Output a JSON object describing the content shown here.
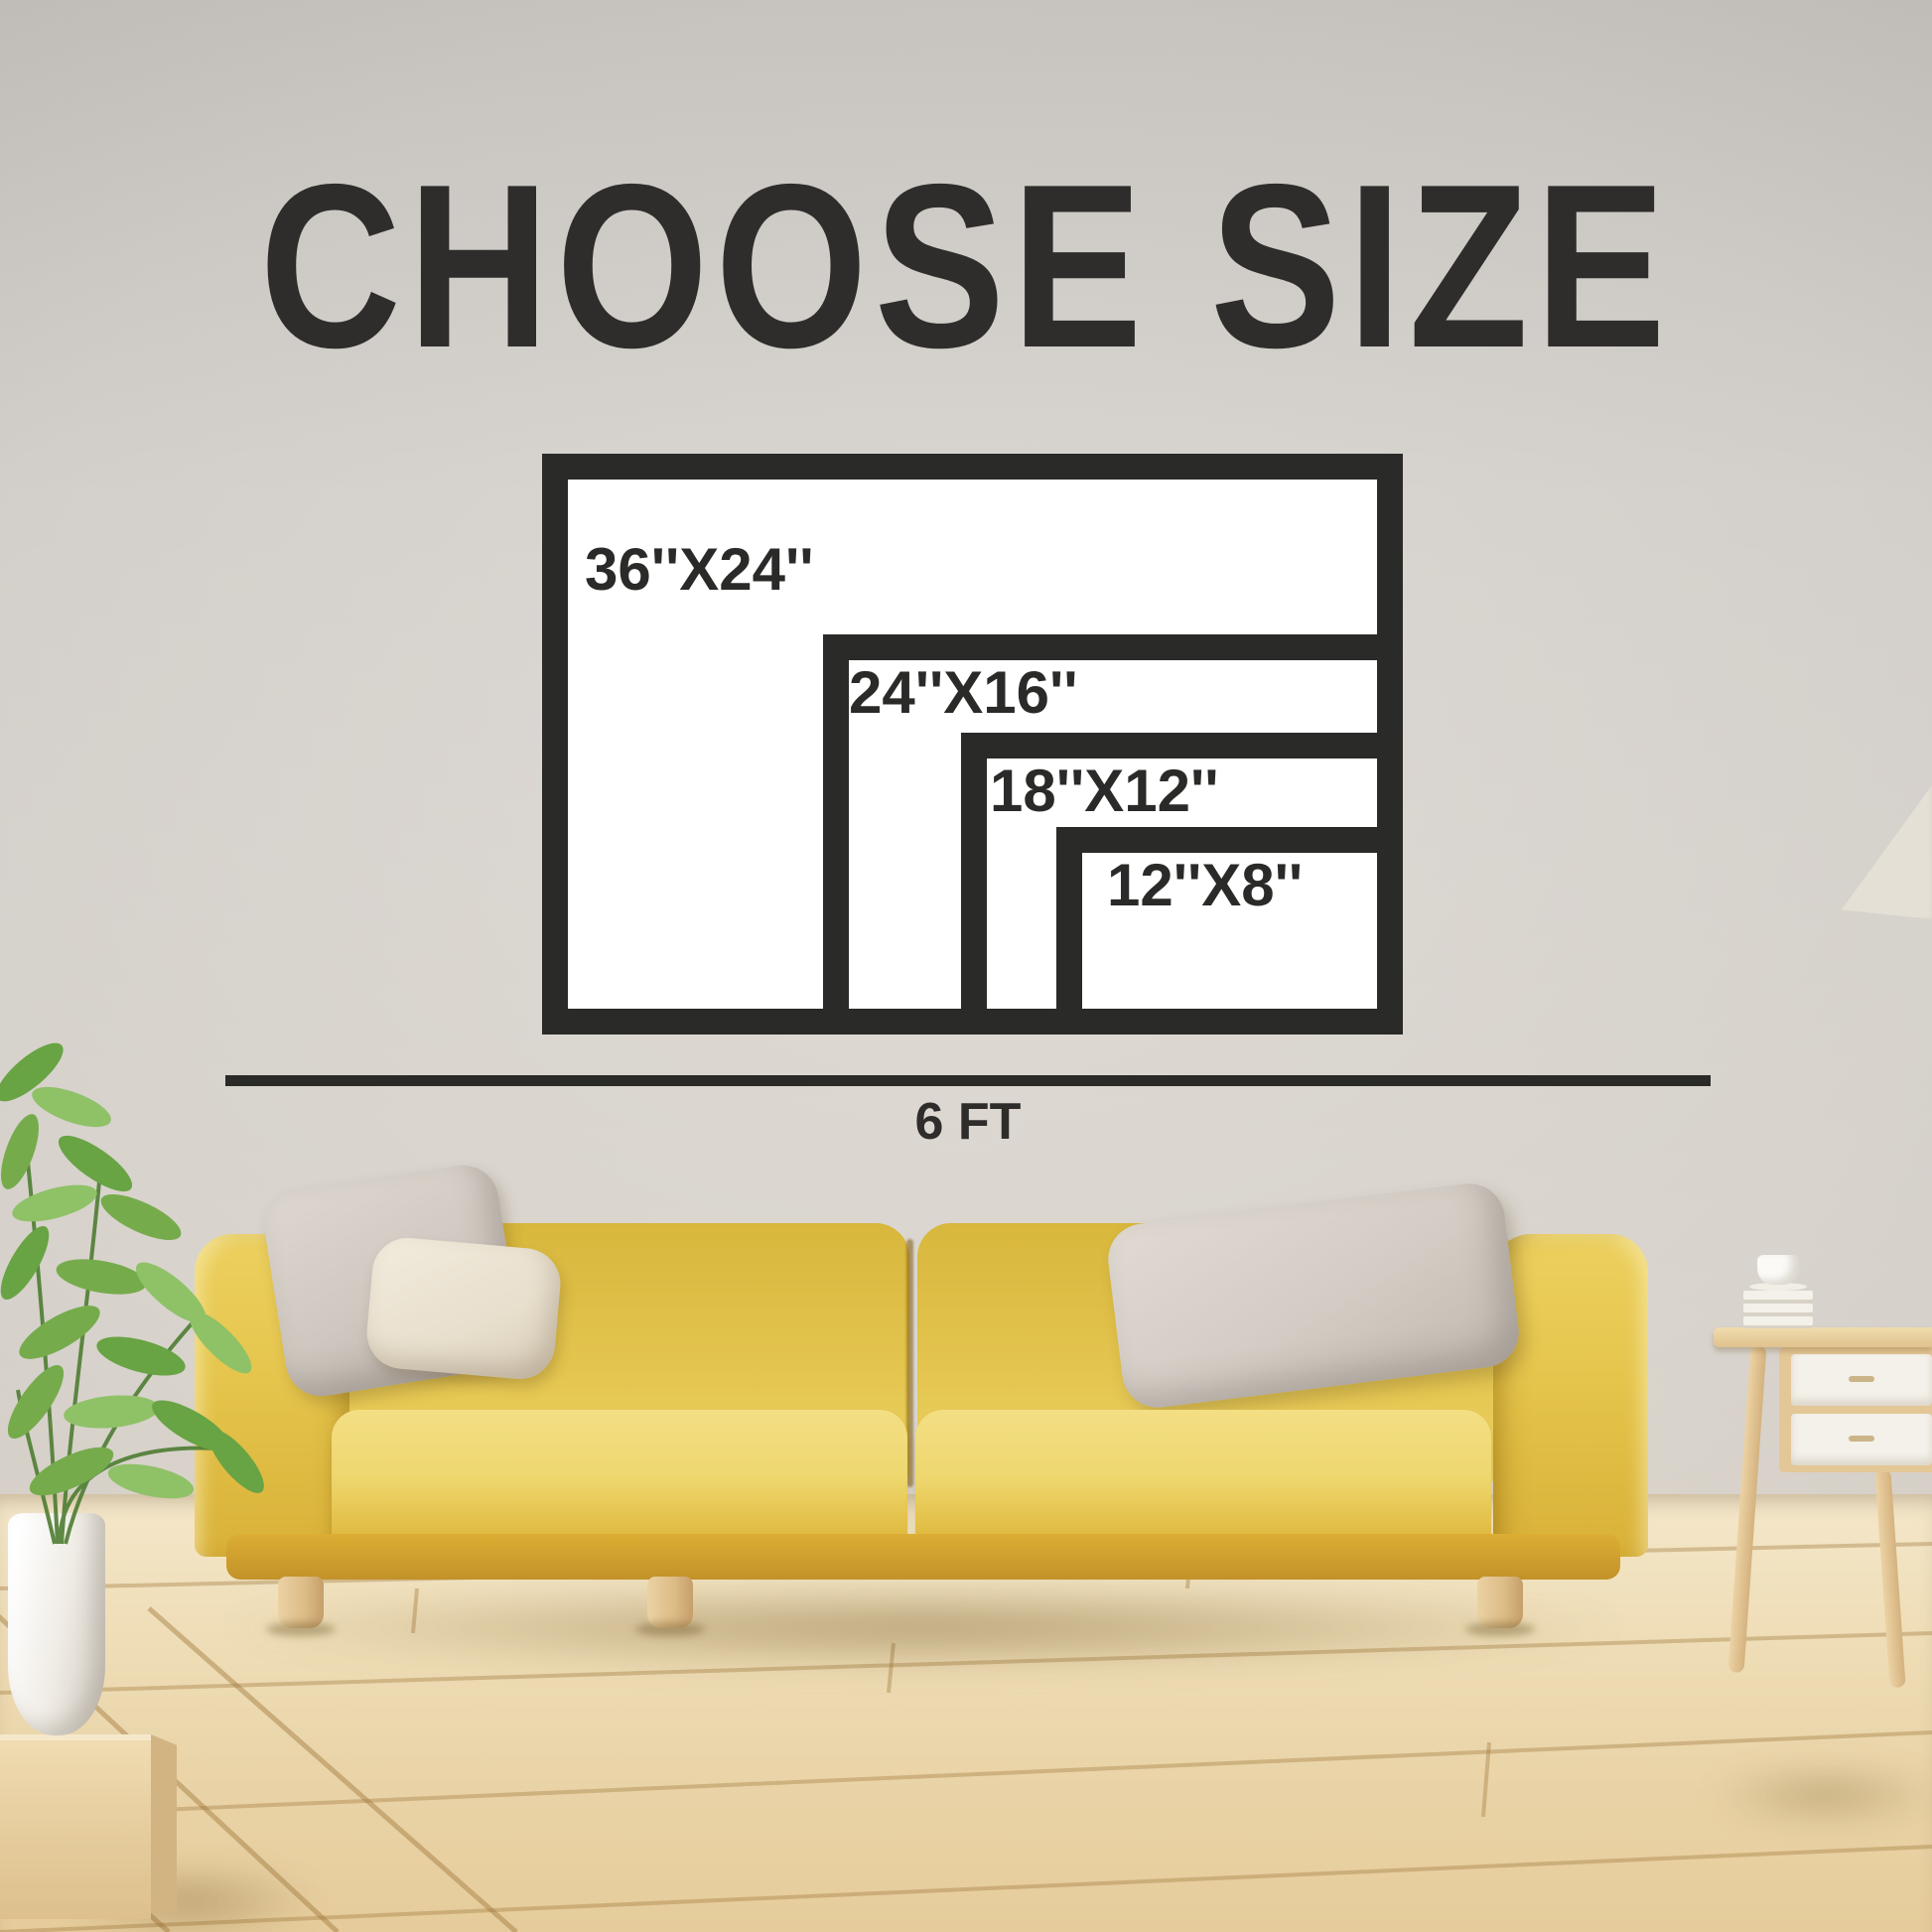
{
  "title": {
    "text": "CHOOSE SIZE"
  },
  "size_chart": {
    "unit": "inches",
    "options": [
      {
        "label": "36''X24''",
        "width_in": 36,
        "height_in": 24
      },
      {
        "label": "24''X16''",
        "width_in": 24,
        "height_in": 16
      },
      {
        "label": "18''X12''",
        "width_in": 18,
        "height_in": 12
      },
      {
        "label": "12''X8''",
        "width_in": 12,
        "height_in": 8
      }
    ],
    "scale": {
      "label": "6 FT",
      "feet": 6
    }
  },
  "colors": {
    "ink": "#2a2a28",
    "frame_fill": "#ffffff",
    "wall_gray": "#cfcbc6",
    "sofa_yellow": "#e5c44d",
    "floor_wood": "#eedcb6",
    "pillow_gray": "#d5cec6",
    "pillow_cream": "#efe8d9",
    "plant_green": "#76ab4c"
  }
}
